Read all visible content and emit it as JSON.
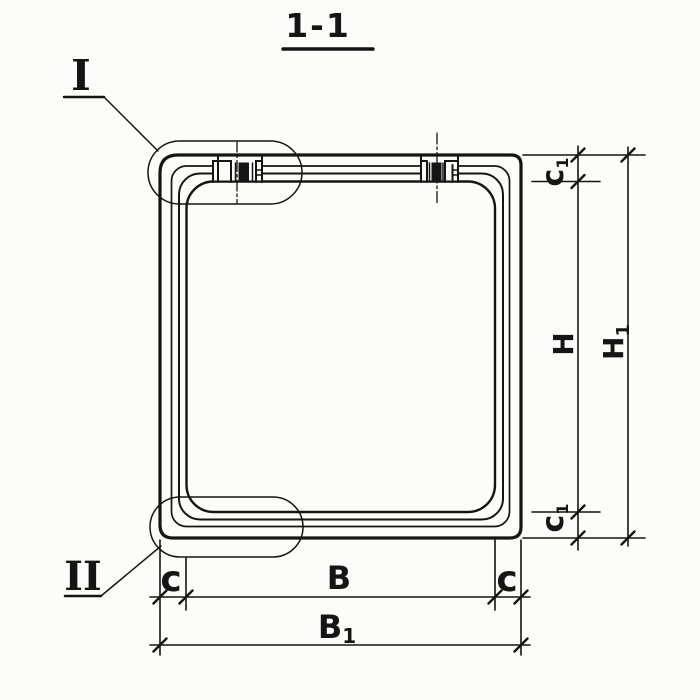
{
  "colors": {
    "ink": "#151515",
    "paper": "#fcfcfb"
  },
  "title": {
    "text": "1-1"
  },
  "details": {
    "marker_top": "I",
    "marker_bottom": "II"
  },
  "dims": {
    "inner_height": "H",
    "overall_height": {
      "main": "H",
      "sub": "1"
    },
    "inner_width": "B",
    "overall_width": {
      "main": "B",
      "sub": "1"
    },
    "wall_thickness": "c",
    "slab_thickness": {
      "main": "c",
      "sub": "1"
    }
  }
}
